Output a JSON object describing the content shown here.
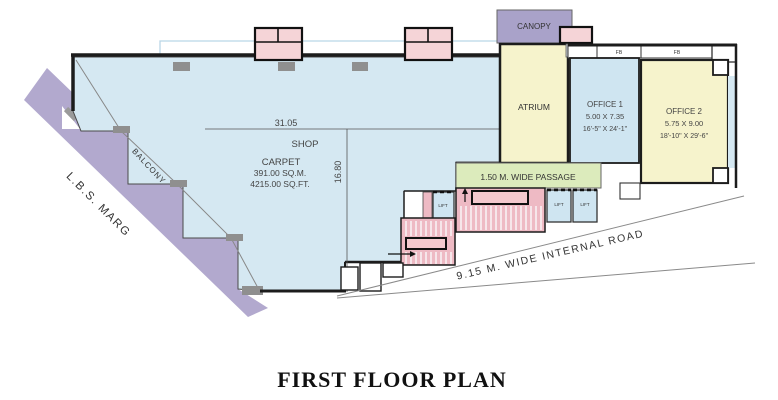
{
  "title": "FIRST FLOOR PLAN",
  "roads": {
    "lbs_marg": "L.B.S. MARG",
    "internal_road": "9.15 M. WIDE  INTERNAL  ROAD"
  },
  "areas": {
    "canopy": "CANOPY",
    "atrium": "ATRIUM",
    "balcony": "BALCONY",
    "passage": "1.50 M. WIDE PASSAGE",
    "shop": {
      "name": "SHOP",
      "carpet": "CARPET",
      "area_sqm": "391.00 SQ.M.",
      "area_sqft": "4215.00 SQ.FT."
    },
    "office1": {
      "name": "OFFICE 1",
      "size_m": "5.00 X 7.35",
      "size_ft": "16'-5\" X 24'-1\""
    },
    "office2": {
      "name": "OFFICE 2",
      "size_m": "5.75 X 9.00",
      "size_ft": "18'-10\" X 29'-6\""
    },
    "lift_label": "LIFT",
    "fb_label": "FB"
  },
  "dimensions": {
    "shop_width_m": "31.05",
    "shop_depth_m": "16.80"
  },
  "colors": {
    "shop_fill": "#d5e8f2",
    "road_fill": "#b2a9ce",
    "canopy_fill": "#a9a2c9",
    "yellow_fill": "#f6f3cc",
    "office1_fill": "#cfe5f1",
    "passage_fill": "#dcebbc",
    "stair_fill": "#eebac4",
    "landing_fill": "#f3c9ce",
    "vent_fill": "#f5d4d7",
    "wall": "#1c1c1c"
  }
}
